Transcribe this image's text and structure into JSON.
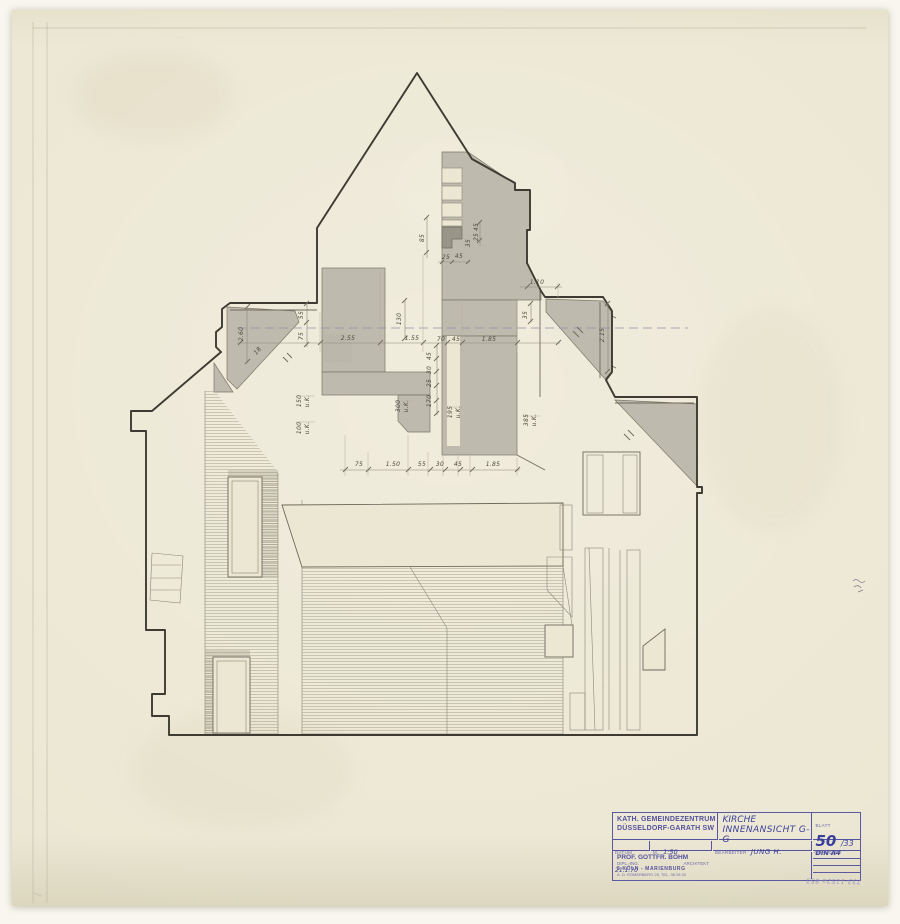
{
  "title_block": {
    "project_line1": "KATH. GEMEINDEZENTRUM",
    "project_line2": "DÜSSELDORF-GARATH SW",
    "drawing_title_line1": "KIRCHE",
    "drawing_title_line2": "INNENANSICHT G-G",
    "blatt_label": "BLATT",
    "blatt_number": "50",
    "blatt_suffix": "/33",
    "format": "DIN A4",
    "datum_label": "DATUM",
    "datum_value": "21.1.70",
    "m_label": "M.",
    "m_value": "1:50",
    "bearbeiter_label": "BEARBEITER",
    "bearbeiter_value": "JUNG H.",
    "geaendert_label": "GEÄNDERT",
    "architect_line1": "PROF. GOTTFR. BÖHM",
    "architect_line2a": "DIPL.-ING.",
    "architect_line2b": "ARCHITEKT",
    "architect_line3": "5 KÖLN - MARIENBURG",
    "architect_line4": "A. D. RÖMERBERG 25, TEL. 38 28 00"
  },
  "annotations": {
    "file_number": "733-1152a-853"
  },
  "drawing": {
    "dimensions": [
      {
        "t": "2.55",
        "x": 348,
        "y": 340
      },
      {
        "t": "1.55",
        "x": 412,
        "y": 340
      },
      {
        "t": "70",
        "x": 441,
        "y": 341
      },
      {
        "t": "45",
        "x": 456,
        "y": 341,
        "s": 5
      },
      {
        "t": "1.85",
        "x": 489,
        "y": 341
      },
      {
        "t": "1.10",
        "x": 537,
        "y": 284
      },
      {
        "t": "2.60",
        "x": 243,
        "y": 334,
        "r": -90
      },
      {
        "t": "55",
        "x": 303,
        "y": 315,
        "r": -90,
        "s": 5
      },
      {
        "t": "75",
        "x": 303,
        "y": 336,
        "r": -90,
        "s": 5
      },
      {
        "t": "18",
        "x": 259,
        "y": 352,
        "r": -50,
        "s": 5
      },
      {
        "t": "130",
        "x": 401,
        "y": 319,
        "r": -90
      },
      {
        "t": "85",
        "x": 424,
        "y": 238,
        "r": -90,
        "s": 5
      },
      {
        "t": "35",
        "x": 470,
        "y": 243,
        "r": -90,
        "s": 5
      },
      {
        "t": "45",
        "x": 478,
        "y": 227,
        "r": -90,
        "s": 4.5
      },
      {
        "t": "25",
        "x": 478,
        "y": 237,
        "r": -90,
        "s": 4.5
      },
      {
        "t": "25",
        "x": 446,
        "y": 259,
        "s": 5
      },
      {
        "t": "45",
        "x": 459,
        "y": 258,
        "s": 5
      },
      {
        "t": "35",
        "x": 527,
        "y": 315,
        "r": -90,
        "s": 5
      },
      {
        "t": "2.15",
        "x": 604,
        "y": 335,
        "r": -90
      },
      {
        "t": "75",
        "x": 359,
        "y": 466,
        "s": 5.5
      },
      {
        "t": "1.50",
        "x": 393,
        "y": 466
      },
      {
        "t": "55",
        "x": 422,
        "y": 466
      },
      {
        "t": "30",
        "x": 440,
        "y": 466
      },
      {
        "t": "45",
        "x": 458,
        "y": 466,
        "s": 5
      },
      {
        "t": "1.85",
        "x": 493,
        "y": 466
      },
      {
        "t": "150",
        "x": 301,
        "y": 401,
        "r": -90,
        "s": 4.5
      },
      {
        "t": "u.K.",
        "x": 309,
        "y": 401,
        "r": -90,
        "s": 4
      },
      {
        "t": "100",
        "x": 301,
        "y": 428,
        "r": -90,
        "s": 4.5
      },
      {
        "t": "u.K.",
        "x": 309,
        "y": 428,
        "r": -90,
        "s": 4
      },
      {
        "t": "300",
        "x": 400,
        "y": 406,
        "r": -90,
        "s": 4.5
      },
      {
        "t": "u.K.",
        "x": 408,
        "y": 406,
        "r": -90,
        "s": 4
      },
      {
        "t": "195",
        "x": 452,
        "y": 412,
        "r": -90,
        "s": 4.5
      },
      {
        "t": "u.K.",
        "x": 460,
        "y": 412,
        "r": -90,
        "s": 4
      },
      {
        "t": "385",
        "x": 528,
        "y": 420,
        "r": -90,
        "s": 4.5
      },
      {
        "t": "u.K.",
        "x": 536,
        "y": 420,
        "r": -90,
        "s": 4
      },
      {
        "t": "45",
        "x": 431,
        "y": 356,
        "r": -90,
        "s": 4.5
      },
      {
        "t": "30",
        "x": 431,
        "y": 370,
        "r": -90,
        "s": 4.5
      },
      {
        "t": "25",
        "x": 431,
        "y": 383,
        "r": -90,
        "s": 4.5
      },
      {
        "t": "170",
        "x": 431,
        "y": 401,
        "r": -90,
        "s": 4.5
      }
    ]
  }
}
